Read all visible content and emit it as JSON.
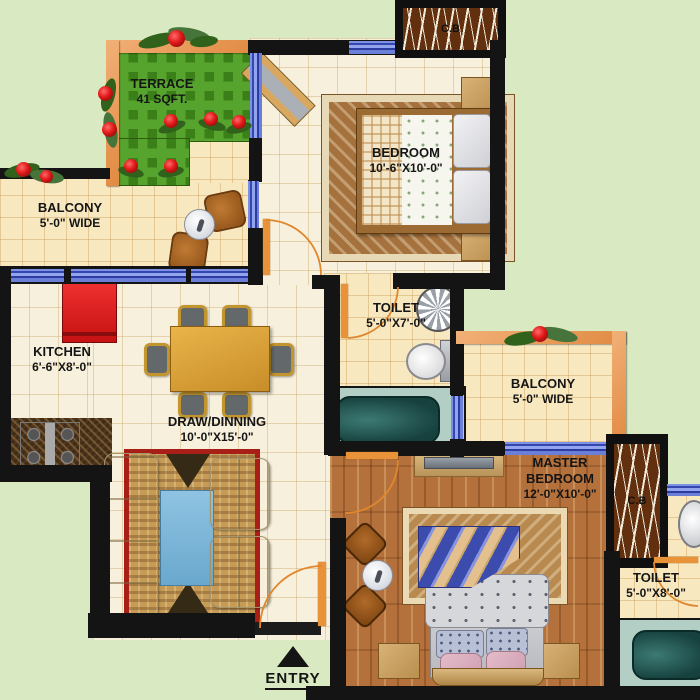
{
  "rooms": {
    "terrace": {
      "label": "TERRACE",
      "size": "41 SQFT."
    },
    "balcony_left": {
      "label": "BALCONY",
      "size": "5'-0\" WIDE"
    },
    "bedroom": {
      "label": "BEDROOM",
      "size": "10'-6\"X10'-0\""
    },
    "toilet_attached": {
      "label": "TOILET",
      "size": "5'-0\"X7'-0\""
    },
    "kitchen": {
      "label": "KITCHEN",
      "size": "6'-6\"X8'-0\""
    },
    "draw_dining": {
      "label": "DRAW/DINNING",
      "size": "10'-0\"X15'-0\""
    },
    "balcony_right": {
      "label": "BALCONY",
      "size": "5'-0\" WIDE"
    },
    "master_bedroom": {
      "label_line1": "MASTER",
      "label_line2": "BEDROOM",
      "size": "12'-0\"X10'-0\""
    },
    "toilet_master": {
      "label": "TOILET",
      "size": "5'-0\"X8'-0\""
    },
    "cupboard_bedroom": {
      "label": "C.B"
    },
    "cupboard_master": {
      "label": "C.B"
    }
  },
  "entry": {
    "label": "ENTRY"
  },
  "colors": {
    "background": "#d9e9c1",
    "wall": "#141414",
    "window_blue": "#5a70cf",
    "balcony_wall_orange": "#e89a5a",
    "terrace_green": "#56a42e",
    "door_arc_orange": "#e0872e",
    "bath_teal": "#b3cec5",
    "carpet_red": "#a81f17",
    "rug_blue": "#7fb6da",
    "wood_floor": "#b4713c",
    "tile_floor": "#f7f0dc"
  }
}
